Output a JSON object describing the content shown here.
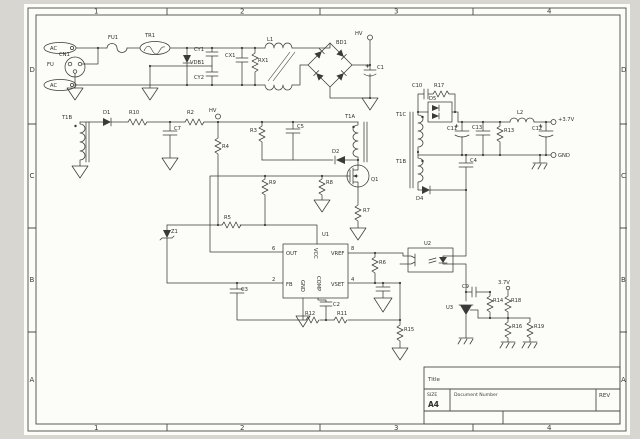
{
  "colors": {
    "ink": "#3a3a38",
    "paper": "#fcfcf8",
    "bg": "#d7d6d1"
  },
  "sheet": {
    "zones_cols": [
      "1",
      "2",
      "3",
      "4"
    ],
    "zones_rows": [
      "D",
      "C",
      "B",
      "A"
    ],
    "title_block": {
      "title_label": "Title",
      "size_label": "SIZE",
      "size_value": "A4",
      "doc_label": "Document Number",
      "rev_label": "REV"
    }
  },
  "sch": {
    "labels": {
      "ac1": "AC",
      "ac2": "AC",
      "cn1": "CN1",
      "fu": "FU",
      "fu1": "FU1",
      "tr1": "TR1",
      "vdb1": "VDB1",
      "cy1": "CY1",
      "cy2": "CY2",
      "cx1": "CX1",
      "rx1": "RX1",
      "l1": "L1",
      "bd1": "BD1",
      "hv_top": "HV",
      "c1": "C1",
      "t1b_aux": "T1B",
      "d1": "D1",
      "r10": "R10",
      "c7": "C7",
      "r2": "R2",
      "hv_mid": "HV",
      "r4": "R4",
      "r5": "R5",
      "z1": "Z1",
      "c3": "C3",
      "r3": "R3",
      "c5": "C5",
      "d2": "D2",
      "t1a": "T1A",
      "q1": "Q1",
      "r9": "R9",
      "r8": "R8",
      "r7": "R7",
      "u1": "U1",
      "pin_out": "OUT",
      "pin_vcc": "VCC",
      "pin_vref": "VREF",
      "pin_fb": "FB",
      "pin_gnd": "GND",
      "pin_comp": "COMP",
      "pin_vset": "VSET",
      "n6": "6",
      "n2": "2",
      "n8": "8",
      "n4": "4",
      "c2": "C2",
      "r12": "R12",
      "r11": "R11",
      "r15": "R15",
      "u2": "U2",
      "r6": "R6",
      "t1c": "T1C",
      "t1b_sec": "T1B",
      "d5": "D5",
      "c10": "C10",
      "r17": "R17",
      "d4": "D4",
      "c4": "C4",
      "c11": "C11",
      "c13": "C13",
      "r13": "R13",
      "l2": "L2",
      "c12": "C12",
      "vout": "+3.7V",
      "gnd": "GND",
      "v37": "3.7V",
      "c9": "C9",
      "r14": "R14",
      "r18": "R18",
      "u3": "U3",
      "r16": "R16",
      "r19": "R19"
    }
  }
}
